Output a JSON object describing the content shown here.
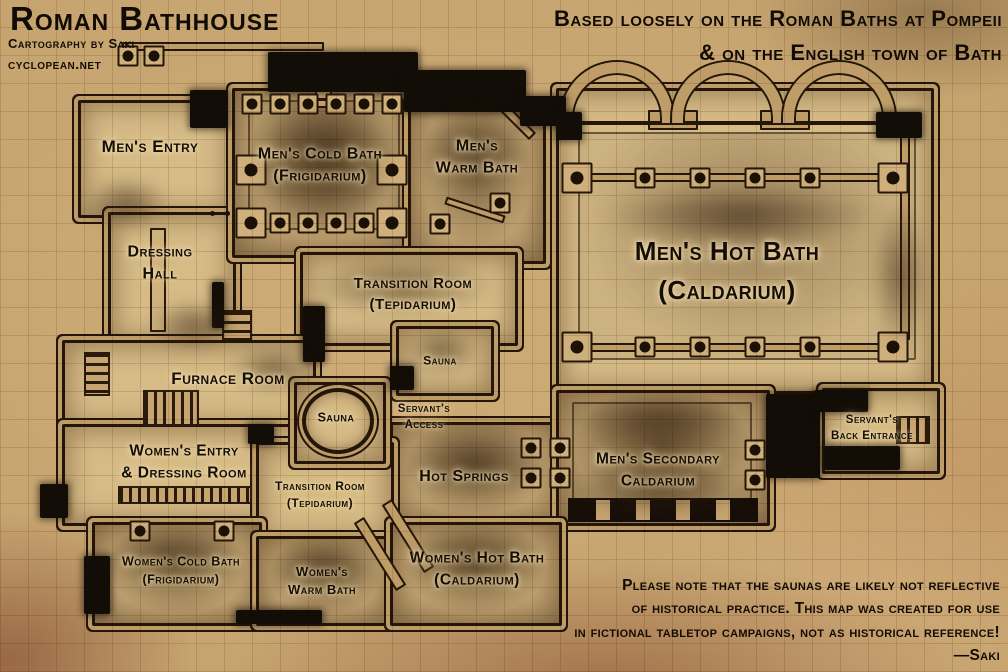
{
  "title_block": {
    "title": "Roman Bathhouse",
    "credit": "Cartography by Saki",
    "website": "cyclopean.net"
  },
  "subtitle": {
    "line1": "Based loosely on the Roman Baths at Pompeii",
    "line2": "& on the English town of Bath"
  },
  "rooms": {
    "mens_entry": {
      "line1": "Men's Entry"
    },
    "mens_cold_bath": {
      "line1": "Men's Cold Bath",
      "line2": "(Frigidarium)"
    },
    "mens_warm_bath": {
      "line1": "Men's",
      "line2": "Warm Bath"
    },
    "dressing_hall": {
      "line1": "Dressing",
      "line2": "Hall"
    },
    "transition_room_mens": {
      "line1": "Transition Room",
      "line2": "(Tepidarium)"
    },
    "mens_hot_bath": {
      "line1": "Men's Hot Bath",
      "line2": "(Caldarium)"
    },
    "sauna_upper": {
      "line1": "Sauna"
    },
    "furnace_room": {
      "line1": "Furnace Room"
    },
    "sauna_round": {
      "line1": "Sauna"
    },
    "servants_access": {
      "line1": "Servant's",
      "line2": "Access"
    },
    "womens_entry": {
      "line1": "Women's Entry",
      "line2": "& Dressing Room"
    },
    "hot_springs": {
      "line1": "Hot Springs"
    },
    "transition_room_womens": {
      "line1": "Transition Room",
      "line2": "(Tepidarium)"
    },
    "mens_secondary_caldarium": {
      "line1": "Men's Secondary",
      "line2": "Caldarium"
    },
    "servants_back_entrance": {
      "line1": "Servant's",
      "line2": "Back Entrance"
    },
    "womens_cold_bath": {
      "line1": "Women's Cold Bath",
      "line2": "(Frigidarium)"
    },
    "womens_warm_bath": {
      "line1": "Women's",
      "line2": "Warm Bath"
    },
    "womens_hot_bath": {
      "line1": "Women's Hot Bath",
      "line2": "(Caldarium)"
    }
  },
  "note": {
    "line1": "Please note that the saunas are likely not reflective",
    "line2": "of historical practice. This map was created for use",
    "line3": "in fictional tabletop campaigns, not as historical reference!",
    "signature": "—Saki"
  },
  "colors": {
    "parchment": "#c5a36e",
    "floor": "#d6bb87",
    "ink": "#150e05",
    "wall_stone": "#bf9d69",
    "void": "#130d07"
  }
}
